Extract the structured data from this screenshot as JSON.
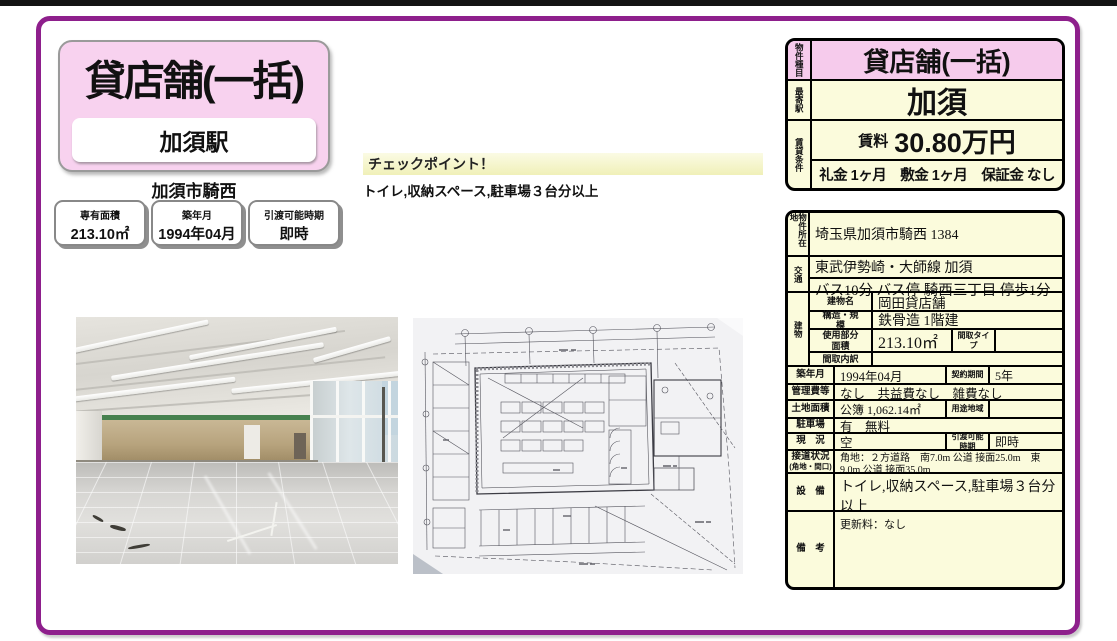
{
  "colors": {
    "accent_purple": "#8E1F8C",
    "pink_header": "#F6CBEC",
    "cream_table": "#FBFBDC",
    "checkpoint_yellow": "#F0F0B8"
  },
  "header": {
    "property_type": "貸店舗(一括)",
    "station_box": "加須駅",
    "area": "加須市騎西"
  },
  "badges": [
    {
      "label": "専有面積",
      "value": "213.10㎡"
    },
    {
      "label": "築年月",
      "value": "1994年04月"
    },
    {
      "label": "引渡可能時期",
      "value": "即時"
    }
  ],
  "checkpoint": {
    "heading": "チェックポイント！",
    "text": "トイレ,収納スペース,駐車場３台分以上"
  },
  "summary": {
    "type_label": "物件種目",
    "type_value": "貸店舗(一括)",
    "station_label": "最寄駅",
    "station_value": "加須",
    "conditions_label": "賃貸条件",
    "rent_label": "賃料",
    "rent_value": "30.80万円",
    "terms": "礼金 1ヶ月　敷金 1ヶ月　保証金 なし"
  },
  "details": {
    "address_label": "物件所在地",
    "address": "埼玉県加須市騎西 1384",
    "transport_label": "交通",
    "transport_line1": "東武伊勢崎・大師線 加須",
    "transport_line2": "バス10分 バス停 騎西三丁目 停歩1分",
    "building_label": "建物",
    "building_name_label": "建物名",
    "building_name": "岡田貸店舗",
    "structure_label": "構造・規模",
    "structure": "鉄骨造 1階建",
    "floor_area_label": "使用部分面積",
    "floor_area": "213.10㎡",
    "layout_type_label": "間取タイプ",
    "layout_type": "",
    "layout_detail_label": "間取内訳",
    "layout_detail": "",
    "built_label": "築年月",
    "built": "1994年04月",
    "contract_label": "契約期間",
    "contract": "5年",
    "management_label": "管理費等",
    "management": "なし　共益費なし　雑費なし",
    "land_label": "土地面積",
    "land": "公簿 1,062.14㎡",
    "zoning_label": "用途地域",
    "zoning": "",
    "parking_label": "駐車場",
    "parking": "有　無料",
    "status_label": "現　況",
    "status": "空",
    "handover_label": "引渡可能時期",
    "handover": "即時",
    "road_label": "接道状況",
    "road_label_sub": "(角地・間口)",
    "road": "角地：２方道路　南7.0m 公道 接面25.0m　東9.0m 公道 接面35.0m",
    "equipment_label": "設　備",
    "equipment": "トイレ,収納スペース,駐車場３台分以上",
    "notes_label": "備　考",
    "notes": "更新料：なし"
  }
}
